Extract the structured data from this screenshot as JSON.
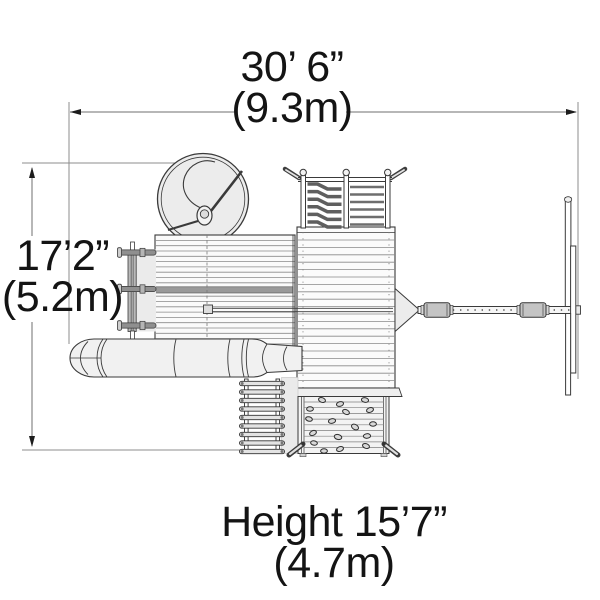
{
  "dimensions": {
    "width": {
      "feet": "30’ 6”",
      "meters": "(9.3m)"
    },
    "depth": {
      "feet": "17’2”",
      "meters": "(5.2m)"
    },
    "height": {
      "feet": "Height 15’7”",
      "meters": "(4.7m)"
    }
  },
  "colors": {
    "line": "#3a3a3a",
    "dim_line": "#8c8c8c",
    "text": "#141414",
    "fill_light": "#ececec",
    "deck_band": "#999999"
  }
}
